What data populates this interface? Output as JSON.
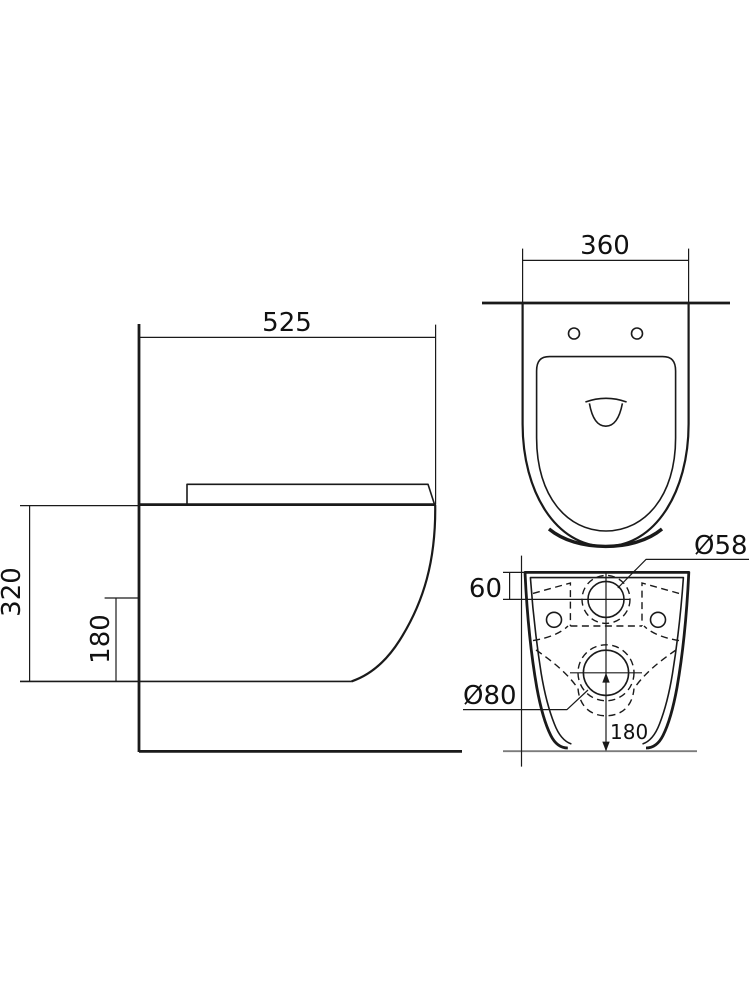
{
  "drawing": {
    "subject": "wall-hung toilet technical drawing",
    "units": "mm",
    "line_color": "#1a1a1a",
    "baseline_color": "#7c7c7c",
    "background_color": "#ffffff"
  },
  "side_view": {
    "name": "side elevation",
    "width": "525",
    "height": "320",
    "outlet_height": "180"
  },
  "plan_view": {
    "name": "top view",
    "width": "360"
  },
  "rear_view": {
    "name": "rear view",
    "inlet_offset": "60",
    "inlet_diameter": "Ø58",
    "outlet_diameter": "Ø80",
    "outlet_height": "180"
  }
}
